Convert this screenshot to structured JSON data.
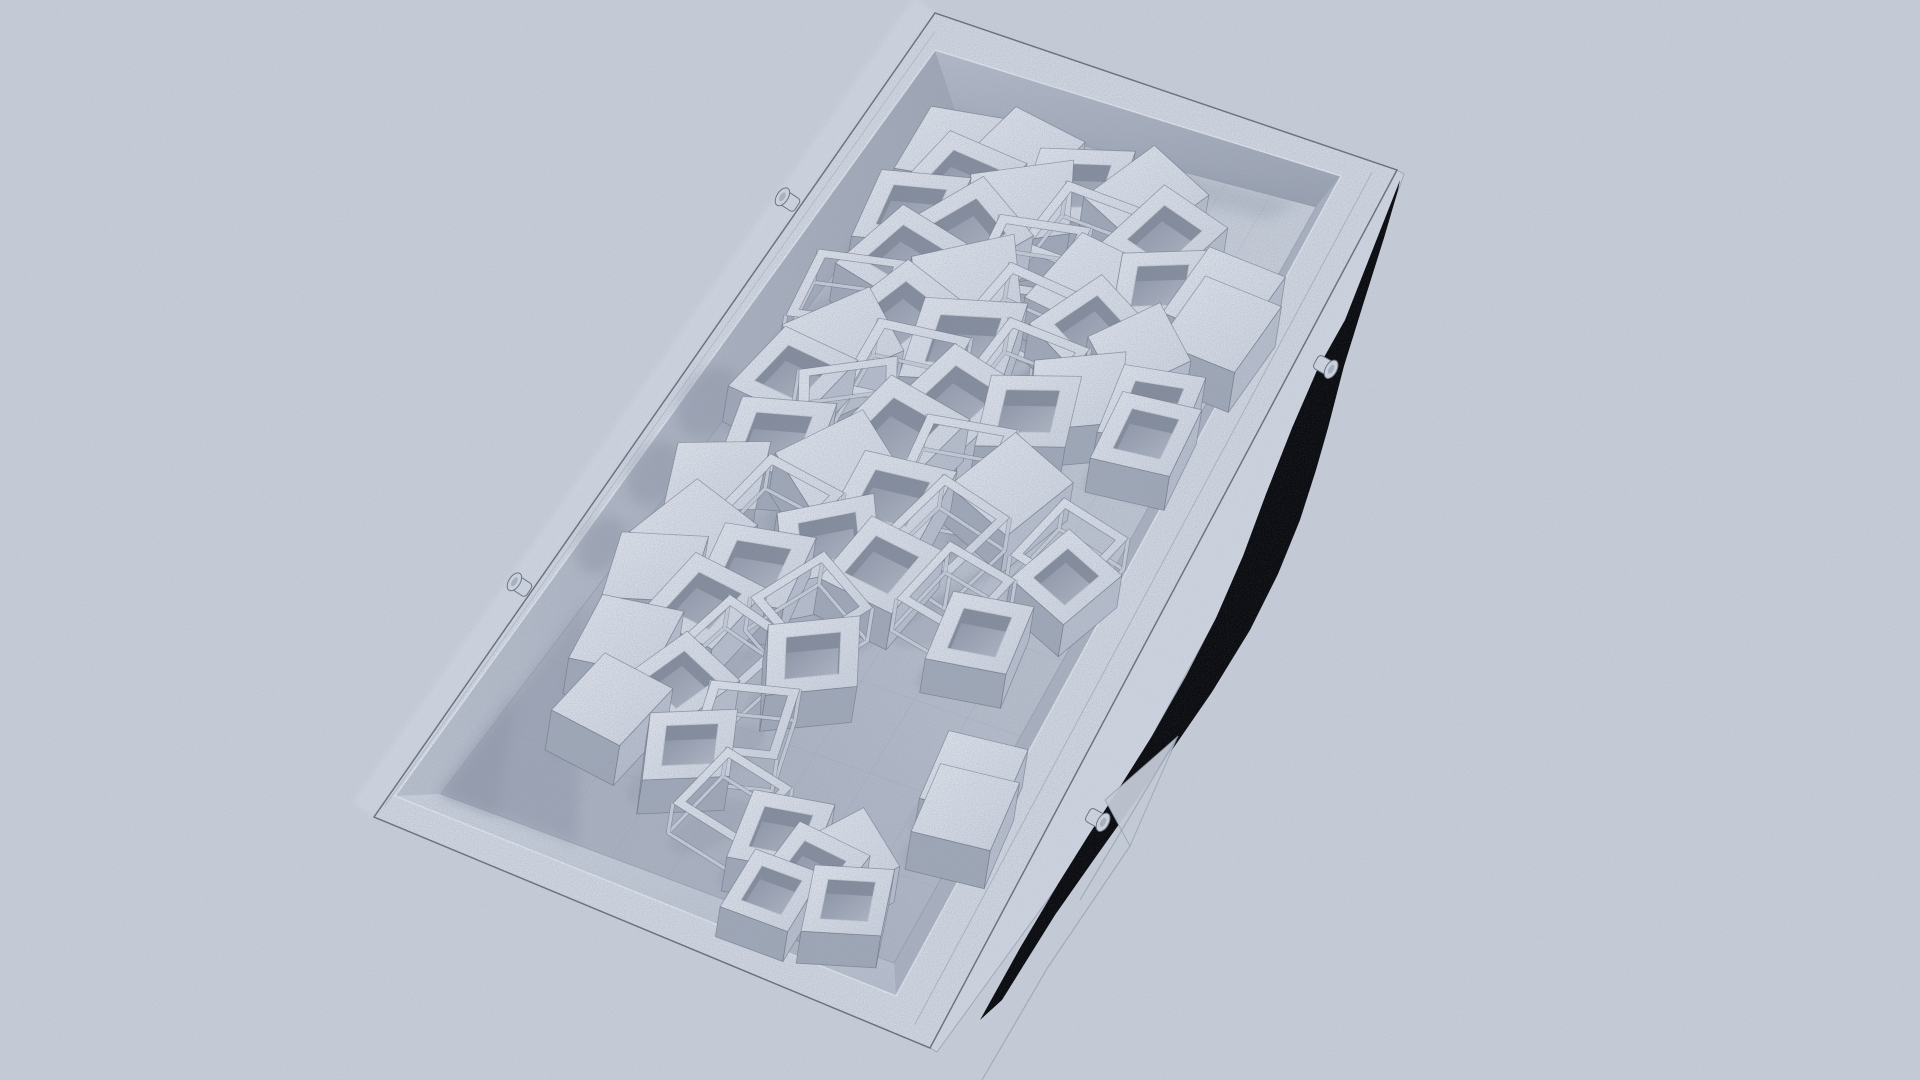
{
  "scene": {
    "description": "Monochrome 3D render of a shallow rectangular tray filled with tumbled hollow cube frames, wireframe cubes and solid cubes; hard black shadow gap along lower-right rail; film-grain texture; no text or UI.",
    "canvas": {
      "width": 1920,
      "height": 1080,
      "background": "#c6cdd9"
    },
    "colors": {
      "background": "#c6cdd9",
      "rim_top": "#d2d8e3",
      "rim_edge": "#6a7383",
      "bevel_line": "#8b94a5",
      "inner_lip": "#e4e9f1",
      "outer_wall_right": "#cdd4e0",
      "outer_glow": "#d7dce6",
      "wall_ul_a": "#b9c1cf",
      "wall_ul_b": "#9fa7b7",
      "wall_ur_a": "#b4bccb",
      "wall_ur_b": "#98a1b1",
      "wall_ll_a": "#ccd3df",
      "wall_ll_b": "#b6becd",
      "wall_lr": "#aab2c1",
      "floor_light": "#c8cfdb",
      "floor_dark": "#aab2c2",
      "grid": "#8d95a6",
      "cube_top_a": "#e0e5ee",
      "cube_top_b": "#ccd3e0",
      "side_light": "#b7bfce",
      "side_dark": "#9fa8b8",
      "hole_a": "#848da0",
      "hole_b": "#b2bac8",
      "hole_wall": "#7f8899",
      "wire_light": "#c9d0dc",
      "stroke": "#5d6575",
      "shadow": "#8e96a8",
      "black": "#07080c",
      "ghost": "#8791a2",
      "peg_a": "#cdd4e0",
      "peg_b": "#aab2c1",
      "grain_rgb": [
        0.3,
        0.33,
        0.4
      ]
    },
    "tray": {
      "outer": [
        [
          935,
          13
        ],
        [
          1397,
          170
        ],
        [
          930,
          1048
        ],
        [
          374,
          817
        ]
      ],
      "rim_inner": [
        [
          935,
          50
        ],
        [
          1341,
          176
        ],
        [
          896,
          996
        ],
        [
          395,
          796
        ]
      ],
      "floor": [
        [
          956,
          112
        ],
        [
          1316,
          207
        ],
        [
          894,
          963
        ],
        [
          441,
          794
        ]
      ],
      "outer_wall_right_poly": [
        [
          1397,
          170
        ],
        [
          1300,
          352
        ],
        [
          1200,
          540
        ],
        [
          1100,
          728
        ],
        [
          1035,
          850
        ],
        [
          930,
          1048
        ],
        [
          937,
          1052
        ],
        [
          1070,
          869
        ],
        [
          1144,
          751
        ],
        [
          1246,
          564
        ],
        [
          1335,
          371
        ],
        [
          1404,
          174
        ]
      ],
      "outer_glow_offset": [
        -21,
        -15
      ]
    },
    "black_shadow": [
      [
        1400,
        180
      ],
      [
        1345,
        320
      ],
      [
        1318,
        368
      ],
      [
        1292,
        428
      ],
      [
        1266,
        494
      ],
      [
        1243,
        556
      ],
      [
        1216,
        618
      ],
      [
        1186,
        676
      ],
      [
        1152,
        736
      ],
      [
        1118,
        790
      ],
      [
        1088,
        836
      ],
      [
        1058,
        884
      ],
      [
        1020,
        948
      ],
      [
        980,
        1020
      ],
      [
        1002,
        1000
      ],
      [
        1055,
        915
      ],
      [
        1095,
        858
      ],
      [
        1132,
        806
      ],
      [
        1172,
        750
      ],
      [
        1212,
        692
      ],
      [
        1250,
        630
      ],
      [
        1278,
        574
      ],
      [
        1300,
        520
      ],
      [
        1316,
        470
      ],
      [
        1328,
        428
      ],
      [
        1344,
        366
      ],
      [
        1362,
        308
      ],
      [
        1384,
        238
      ],
      [
        1398,
        190
      ]
    ],
    "ghost_panel": {
      "blade": [
        [
          1178,
          736
        ],
        [
          1130,
          846
        ],
        [
          1105,
          800
        ]
      ],
      "lines": [
        [
          [
            1130,
            846
          ],
          [
            1048,
            967
          ],
          [
            982,
            1080
          ]
        ],
        [
          [
            1178,
            736
          ],
          [
            1080,
            900
          ]
        ]
      ]
    },
    "pegs": [
      {
        "x": 795,
        "y": 205,
        "a": 213
      },
      {
        "x": 527,
        "y": 590,
        "a": 213
      },
      {
        "x": 1318,
        "y": 362,
        "a": 29
      },
      {
        "x": 1090,
        "y": 815,
        "a": 29
      }
    ],
    "floor_grid": {
      "u_lines": [
        0.1,
        0.2,
        0.3,
        0.4,
        0.5,
        0.6,
        0.7,
        0.8,
        0.9
      ],
      "v_lines": [
        0.125,
        0.25,
        0.375,
        0.5,
        0.625,
        0.75,
        0.875
      ],
      "opacity": 0.15
    },
    "cluster_shadow": [
      [
        0.02,
        0.06
      ],
      [
        0.05,
        0.74
      ],
      [
        0.45,
        0.72
      ],
      [
        0.62,
        0.4
      ],
      [
        0.5,
        0.1
      ]
    ],
    "wall_wedges": [
      {
        "pts": [
          [
            0.72,
            0.0
          ],
          [
            1.0,
            0.0
          ],
          [
            1.0,
            0.3
          ]
        ],
        "o": 0.45
      },
      {
        "pts": [
          [
            0.85,
            0.0
          ],
          [
            1.0,
            0.0
          ],
          [
            1.0,
            0.12
          ]
        ],
        "o": 0.5
      },
      {
        "pts": [
          [
            0.0,
            0.0
          ],
          [
            0.62,
            0.0
          ],
          [
            0.62,
            0.035
          ],
          [
            0.0,
            0.045
          ]
        ],
        "o": 0.3
      },
      {
        "pts": [
          [
            0.0,
            0.1
          ],
          [
            0.0,
            0.95
          ],
          [
            0.03,
            0.9
          ],
          [
            0.035,
            0.15
          ]
        ],
        "o": 0.3
      }
    ],
    "wall_blobs": [
      {
        "x": 708,
        "y": 402,
        "rx": 38,
        "ry": 26,
        "rot": -56
      },
      {
        "x": 655,
        "y": 473,
        "rx": 34,
        "ry": 24,
        "rot": -56
      },
      {
        "x": 602,
        "y": 545,
        "rx": 30,
        "ry": 22,
        "rot": -56
      }
    ],
    "stripe_shadows": [
      {
        "a": [
          0.16,
          0.5
        ],
        "b": [
          0.34,
          0.24
        ],
        "w": 0.03
      },
      {
        "a": [
          0.2,
          0.58
        ],
        "b": [
          0.4,
          0.3
        ],
        "w": 0.026
      },
      {
        "a": [
          0.26,
          0.62
        ],
        "b": [
          0.46,
          0.36
        ],
        "w": 0.03
      },
      {
        "a": [
          0.32,
          0.66
        ],
        "b": [
          0.5,
          0.42
        ],
        "w": 0.024
      },
      {
        "a": [
          0.38,
          0.7
        ],
        "b": [
          0.56,
          0.46
        ],
        "w": 0.028
      },
      {
        "a": [
          0.12,
          0.4
        ],
        "b": [
          0.28,
          0.18
        ],
        "w": 0.026
      },
      {
        "a": [
          0.44,
          0.74
        ],
        "b": [
          0.62,
          0.52
        ],
        "w": 0.024
      },
      {
        "a": [
          0.5,
          0.78
        ],
        "b": [
          0.68,
          0.56
        ],
        "w": 0.022
      }
    ],
    "cubes": [
      [
        0.04,
        0.05,
        -6,
        40,
        "s",
        74
      ],
      [
        0.03,
        0.22,
        12,
        42,
        "s",
        40
      ],
      [
        0.05,
        0.4,
        -15,
        44,
        "f",
        38
      ],
      [
        0.04,
        0.58,
        25,
        42,
        "s",
        40
      ],
      [
        0.08,
        0.12,
        8,
        44,
        "f",
        38
      ],
      [
        0.09,
        0.3,
        -28,
        46,
        "s",
        42
      ],
      [
        0.1,
        0.48,
        5,
        44,
        "w",
        38
      ],
      [
        0.08,
        0.68,
        18,
        42,
        "f",
        36
      ],
      [
        0.13,
        0.06,
        -12,
        42,
        "f",
        36
      ],
      [
        0.14,
        0.22,
        30,
        46,
        "f",
        40
      ],
      [
        0.15,
        0.4,
        -8,
        44,
        "w",
        38
      ],
      [
        0.16,
        0.58,
        10,
        44,
        "s",
        40
      ],
      [
        0.14,
        0.74,
        -20,
        40,
        "f",
        34
      ],
      [
        0.19,
        0.12,
        15,
        44,
        "f",
        38
      ],
      [
        0.2,
        0.3,
        -35,
        46,
        "s",
        40
      ],
      [
        0.22,
        0.47,
        8,
        46,
        "w",
        40
      ],
      [
        0.21,
        0.64,
        28,
        42,
        "f",
        36
      ],
      [
        0.25,
        0.05,
        -10,
        42,
        "w",
        36
      ],
      [
        0.26,
        0.21,
        20,
        46,
        "f",
        40
      ],
      [
        0.27,
        0.38,
        -15,
        48,
        "f",
        42
      ],
      [
        0.28,
        0.55,
        5,
        44,
        "w",
        38
      ],
      [
        0.29,
        0.7,
        -25,
        42,
        "s",
        38
      ],
      [
        0.31,
        0.12,
        38,
        44,
        "s",
        40
      ],
      [
        0.32,
        0.29,
        -5,
        46,
        "w",
        40
      ],
      [
        0.34,
        0.45,
        15,
        46,
        "f",
        40
      ],
      [
        0.33,
        0.62,
        -18,
        42,
        "f",
        36
      ],
      [
        0.37,
        0.07,
        8,
        42,
        "f",
        36
      ],
      [
        0.38,
        0.22,
        -30,
        44,
        "w",
        38
      ],
      [
        0.4,
        0.37,
        12,
        48,
        "f",
        42
      ],
      [
        0.41,
        0.53,
        -8,
        44,
        "w",
        38
      ],
      [
        0.42,
        0.68,
        22,
        42,
        "s",
        38
      ],
      [
        0.45,
        0.13,
        -15,
        44,
        "f",
        38
      ],
      [
        0.46,
        0.3,
        35,
        46,
        "s",
        40
      ],
      [
        0.48,
        0.45,
        -5,
        46,
        "f",
        40
      ],
      [
        0.49,
        0.6,
        15,
        42,
        "w",
        36
      ],
      [
        0.52,
        0.07,
        -22,
        42,
        "s",
        38
      ],
      [
        0.53,
        0.23,
        10,
        44,
        "w",
        38
      ],
      [
        0.55,
        0.38,
        -35,
        44,
        "f",
        38
      ],
      [
        0.56,
        0.52,
        8,
        42,
        "f",
        36
      ],
      [
        0.59,
        0.1,
        18,
        42,
        "s",
        38
      ],
      [
        0.61,
        0.27,
        -10,
        44,
        "f",
        38
      ],
      [
        0.63,
        0.43,
        28,
        42,
        "w",
        36
      ],
      [
        0.65,
        0.08,
        -18,
        40,
        "s",
        36
      ],
      [
        0.67,
        0.22,
        8,
        42,
        "f",
        36
      ],
      [
        0.69,
        0.5,
        -28,
        42,
        "f",
        36
      ],
      [
        0.71,
        0.33,
        15,
        42,
        "w",
        36
      ],
      [
        0.74,
        0.12,
        -8,
        40,
        "s",
        36
      ],
      [
        0.77,
        0.28,
        22,
        40,
        "f",
        34
      ],
      [
        0.79,
        0.45,
        -15,
        42,
        "w",
        34
      ],
      [
        0.82,
        0.18,
        8,
        40,
        "s",
        40
      ],
      [
        0.84,
        0.38,
        -25,
        40,
        "f",
        34
      ],
      [
        0.88,
        0.52,
        12,
        40,
        "w",
        32
      ],
      [
        0.9,
        0.65,
        -10,
        40,
        "f",
        34
      ],
      [
        0.93,
        0.75,
        6,
        40,
        "f",
        34
      ],
      [
        0.95,
        0.85,
        -18,
        38,
        "f",
        32
      ],
      [
        0.97,
        0.7,
        0,
        36,
        "f",
        30
      ],
      [
        0.9,
        0.8,
        35,
        38,
        "s",
        36
      ],
      [
        0.13,
        0.9,
        6,
        42,
        "s",
        40
      ],
      [
        0.165,
        0.93,
        6,
        42,
        "s",
        40
      ],
      [
        0.28,
        0.88,
        -8,
        40,
        "f",
        34
      ],
      [
        0.315,
        0.905,
        -4,
        40,
        "f",
        34
      ],
      [
        0.47,
        0.88,
        14,
        40,
        "w",
        34
      ],
      [
        0.505,
        0.91,
        22,
        38,
        "f",
        32
      ],
      [
        0.76,
        0.95,
        -6,
        40,
        "s",
        38
      ],
      [
        0.8,
        0.97,
        -6,
        40,
        "s",
        38
      ],
      [
        0.22,
        0.78,
        40,
        38,
        "s",
        34
      ],
      [
        0.6,
        0.8,
        -8,
        40,
        "f",
        34
      ],
      [
        0.56,
        0.7,
        12,
        40,
        "w",
        34
      ]
    ]
  }
}
